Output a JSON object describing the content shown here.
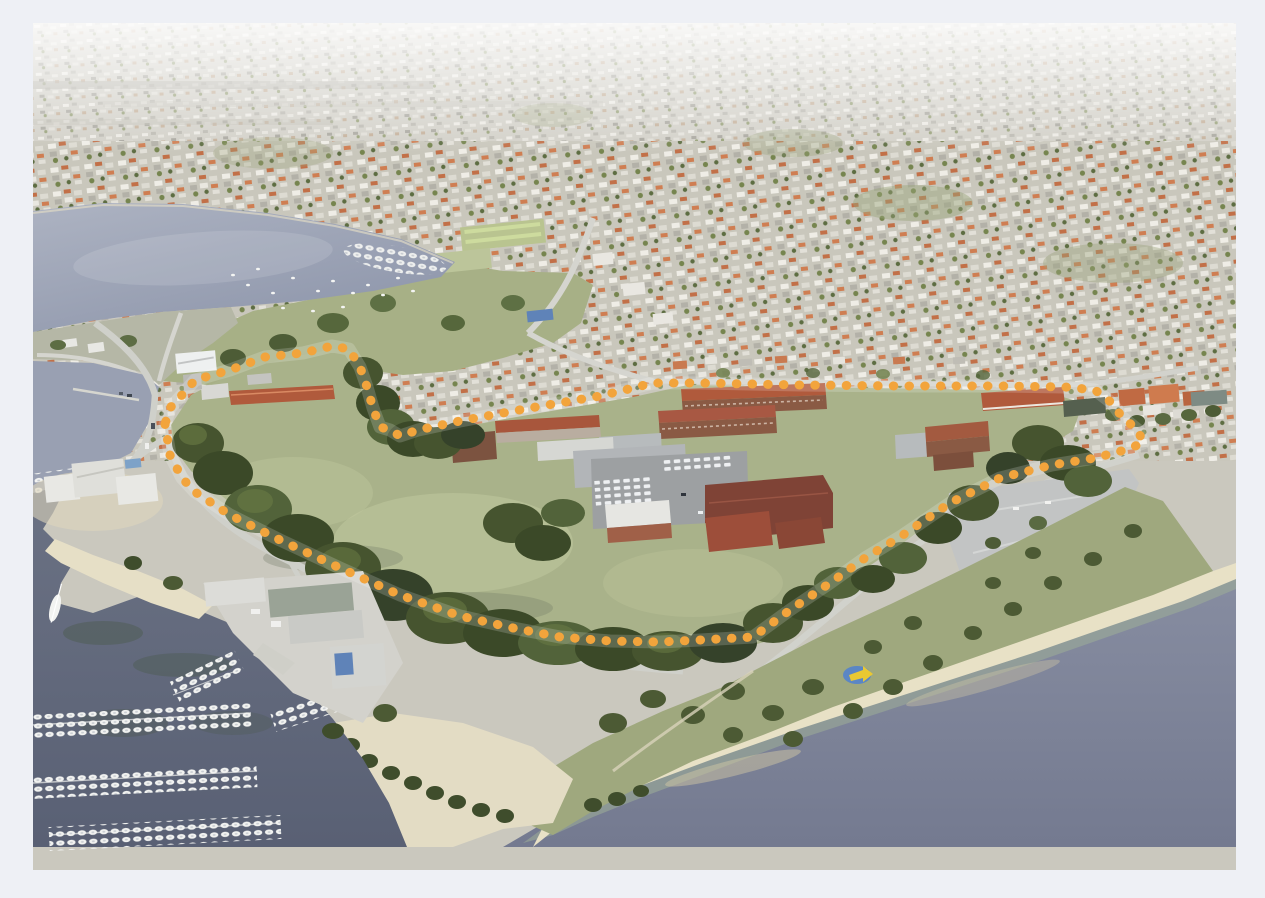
{
  "meta": {
    "title": "Oblique aerial 3D view of riverside heritage precinct",
    "description": "Bird's-eye photograph of a foreshore campus site outlined with an orange dotted boundary; surrounding suburbs above, a bay with moored boats upper-left, a marina with boat pens lower-left, beach foreshore and river across the bottom.",
    "text_on_image": ""
  },
  "frame": {
    "background": "#eef0f5"
  },
  "photo": {
    "left": 33,
    "top": 23,
    "width": 1203,
    "height": 847
  },
  "palette": {
    "far_city": "#d2d0c8",
    "suburb": "#c9c7bc",
    "bay_light": "#adb3c2",
    "bay_dark": "#8e96ab",
    "river_light": "#878da1",
    "river_dark": "#747a90",
    "marina_light": "#6b7284",
    "marina_dark": "#596074",
    "shallow_water": "#9fae97",
    "sand": "#e8e1c6",
    "field": "#a9b28a",
    "park": "#a7b086",
    "foreshore": "#9fa87e",
    "tree_dark": "#3b4928",
    "tree_mid": "#46542f",
    "tree_light": "#6b7d46",
    "road": "#d1d2cc",
    "parking_dark": "#9da0a2",
    "parking_light": "#c2c4c4",
    "roof_terracotta": "#b05a3c",
    "roof_maroon": "#7f4336",
    "roof_red": "#9d4e3a",
    "brick": "#8a5a44",
    "building_white": "#e6e6e2",
    "building_gray": "#b7bbbd",
    "boat_white": "#f2f3f1",
    "playground_blue": "#5b86c4",
    "playground_yellow": "#e9c832"
  },
  "boundary": {
    "name": "site-boundary",
    "style": "dotted",
    "color": "#F2A43C",
    "dot_diameter_px": 9,
    "dot_gap_px": 15,
    "points": "132,401 137,432 149,455 162,469 197,492 247,517 307,545 367,572 427,593 480,605 527,614 577,618 627,619 667,617 720,614 757,587 797,560 832,535 867,514 917,480 967,455 1019,442 1062,435 1092,427 1110,420 1105,407 1089,394 1079,380 1062,367 1032,364 967,363 867,363 767,362 667,360 620,360 567,373 497,385 427,398 385,407 367,413 357,407 347,404 340,385 334,364 327,344 316,326 299,323 270,330 232,334 197,347 162,357 149,372 137,385"
  },
  "scene": {
    "regions": [
      "distant-suburbs",
      "harbour-bay",
      "moored-boats",
      "park-and-playing-fields",
      "heritage-site-field",
      "campus-buildings",
      "central-parking",
      "east-parking",
      "marina",
      "boat-pens",
      "yacht-club",
      "boatyard",
      "beach-foreshore",
      "playground",
      "river"
    ]
  }
}
